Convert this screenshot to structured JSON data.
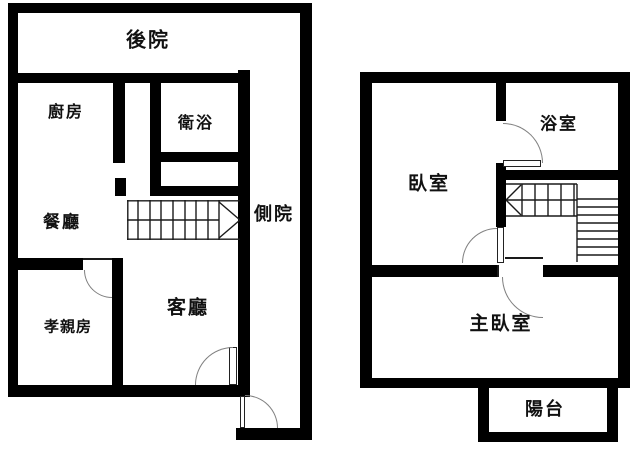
{
  "colors": {
    "wall": "#000000",
    "thin_line": "#1a1a1a",
    "door_arc": "#808080",
    "background": "#ffffff",
    "text": "#111111"
  },
  "plans": [
    {
      "name": "first-floor",
      "rooms": [
        {
          "id": "backyard",
          "label": "後院"
        },
        {
          "id": "kitchen",
          "label": "廚房"
        },
        {
          "id": "bathroom",
          "label": "衛浴"
        },
        {
          "id": "dining-room",
          "label": "餐廳"
        },
        {
          "id": "side-yard",
          "label": "側院"
        },
        {
          "id": "parents-room",
          "label": "孝親房"
        },
        {
          "id": "living-room",
          "label": "客廳"
        }
      ]
    },
    {
      "name": "second-floor",
      "rooms": [
        {
          "id": "bedroom",
          "label": "臥室"
        },
        {
          "id": "bathroom",
          "label": "浴室"
        },
        {
          "id": "master-bedroom",
          "label": "主臥室"
        },
        {
          "id": "balcony",
          "label": "陽台"
        }
      ]
    }
  ]
}
